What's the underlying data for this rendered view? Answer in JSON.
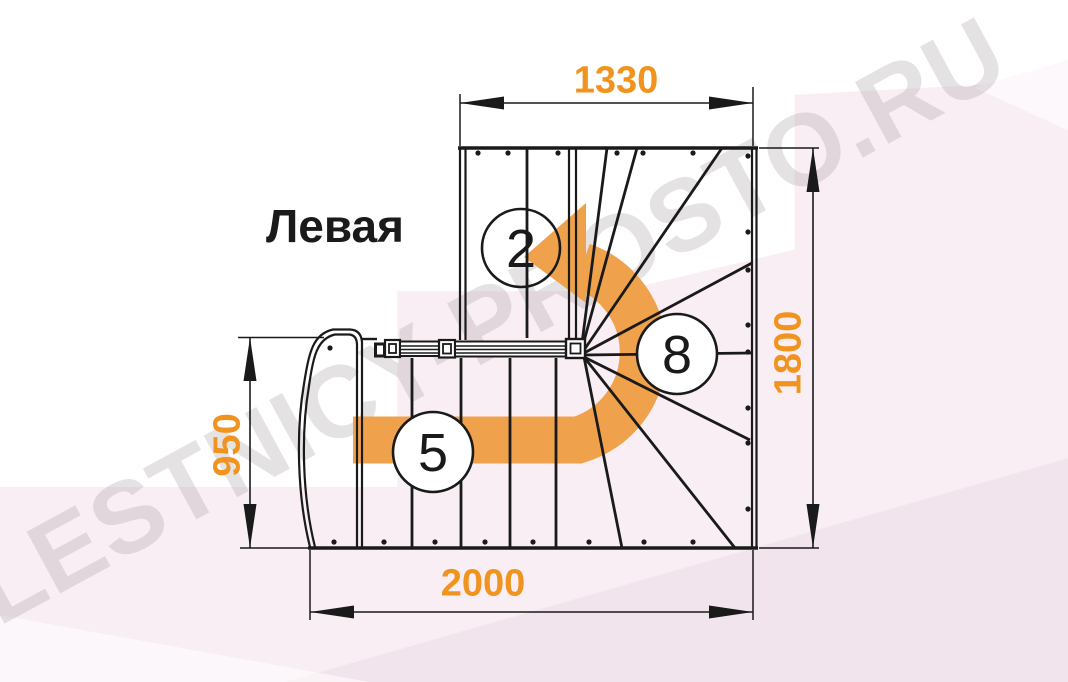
{
  "drawing": {
    "orientation_label": "Левая",
    "watermark": "LESTNICY-PROSTO.RU",
    "dimensions_mm": {
      "upper_flight_length": "1330",
      "overall_depth": "1800",
      "lower_flight_width": "950",
      "overall_length": "2000"
    },
    "step_counts": {
      "upper_flight": "2",
      "lower_flight": "5",
      "winder": "8"
    },
    "colors": {
      "dimension_text": "#F0941F",
      "direction_arrow": "#EFA24B",
      "linework": "#1A1A1A",
      "background_pink": "#F8EEF4",
      "background_pink_deep": "#F2E4EC",
      "watermark_gray": "#A89FA6"
    }
  }
}
